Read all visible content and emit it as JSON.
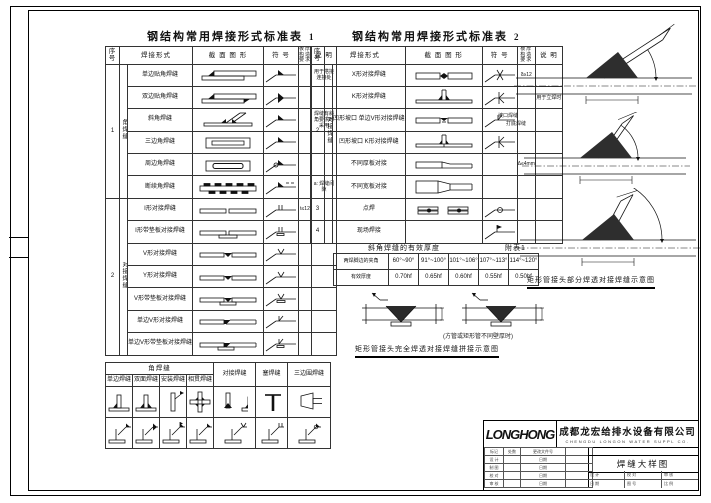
{
  "sheet": {
    "bg": "#ffffff",
    "line_color": "#111111"
  },
  "table1": {
    "title": "钢结构常用焊接形式标准表",
    "title_no": "1",
    "headers": [
      "序 号",
      "焊接形式",
      "截 面 图 形",
      "符 号",
      "板厚构造要求",
      "说 明"
    ],
    "groups": [
      {
        "no": "1",
        "form": "角焊缝",
        "rows": [
          {
            "label": "单边贴角焊缝",
            "fig": "lap1",
            "sym": "fil",
            "thk": "",
            "note": "用于搭接连接处"
          },
          {
            "label": "双边贴角焊缝",
            "fig": "lap2",
            "sym": "fil2",
            "thk": "",
            "note": ""
          },
          {
            "label": "斜角焊缝",
            "fig": "bevel",
            "sym": "fil",
            "thk": "",
            "note": "焊缝有斜角要求时采用"
          },
          {
            "label": "三边角焊缝",
            "fig": "rect3",
            "sym": "fil",
            "thk": "",
            "note": ""
          },
          {
            "label": "周边角焊缝",
            "fig": "perim",
            "sym": "filP",
            "thk": "",
            "note": ""
          },
          {
            "label": "断续角焊缝",
            "fig": "interm",
            "sym": "filD",
            "thk": "",
            "note": "a: 焊缝间隙"
          }
        ]
      },
      {
        "no": "2",
        "form": "对接焊缝",
        "rows": [
          {
            "label": "I形对接焊缝",
            "fig": "buttI",
            "sym": "symI",
            "thk": "t≤12",
            "note": ""
          },
          {
            "label": "I形带垫板对接焊缝",
            "fig": "buttIB",
            "sym": "symIb",
            "thk": "",
            "note": ""
          },
          {
            "label": "V形对接焊缝",
            "fig": "buttV",
            "sym": "symV",
            "thk": "",
            "note": ""
          },
          {
            "label": "Y形对接焊缝",
            "fig": "buttY",
            "sym": "symV",
            "thk": "",
            "note": ""
          },
          {
            "label": "V形带垫板对接焊缝",
            "fig": "buttVB",
            "sym": "symVb",
            "thk": "",
            "note": ""
          },
          {
            "label": "单边V形对接焊缝",
            "fig": "bevS",
            "sym": "symBev",
            "thk": "",
            "note": ""
          },
          {
            "label": "单边V形带垫板对接焊缝",
            "fig": "bevSB",
            "sym": "symBevB",
            "thk": "",
            "note": ""
          }
        ]
      }
    ]
  },
  "table2": {
    "title": "钢结构常用焊接形式标准表",
    "title_no": "2",
    "headers": [
      "序 号",
      "焊接形式",
      "截 面 图 形",
      "符 号",
      "板厚构造要求",
      "说 明"
    ],
    "groups": [
      {
        "no": "2",
        "form": "对接焊缝",
        "rows": [
          {
            "label": "X形对接焊缝",
            "fig": "buttX",
            "sym": "symX",
            "thk": "δ≥12",
            "note": ""
          },
          {
            "label": "K形对接焊缝",
            "fig": "buttK",
            "sym": "symK",
            "thk": "",
            "note": "用于立焊时"
          },
          {
            "label": "凹形坡口 单边V形对接焊缝",
            "fig": "bluntV",
            "sym": "symBev",
            "thk": "",
            "note": ""
          },
          {
            "label": "凹形坡口 K形对接焊缝",
            "fig": "bluntK",
            "sym": "symK",
            "thk": "",
            "note": ""
          },
          {
            "label": "不同厚板对接",
            "fig": "thick",
            "sym": "symNone",
            "thk": "Δ≤4mm",
            "note": ""
          },
          {
            "label": "不同宽板对接",
            "fig": "width",
            "sym": "symNone",
            "thk": "",
            "note": ""
          }
        ]
      },
      {
        "no": "3",
        "form": "",
        "rows": [
          {
            "label": "点焊",
            "fig": "spot",
            "sym": "symSpot",
            "thk": "",
            "note": ""
          }
        ]
      },
      {
        "no": "4",
        "form": "",
        "rows": [
          {
            "label": "现场焊接",
            "fig": "blank",
            "sym": "symField",
            "thk": "",
            "note": ""
          }
        ]
      }
    ]
  },
  "appendix": {
    "title": "斜角焊缝的有效厚度",
    "ref": "附表1",
    "row1_label": "两焊脚边的夹角",
    "row2_label": "有效厚度",
    "angles": [
      "60°~90°",
      "91°~100°",
      "101°~106°",
      "107°~113°",
      "114°~120°"
    ],
    "values": [
      "0.70hf",
      "0.65hf",
      "0.60hf",
      "0.55hf",
      "0.50hf"
    ]
  },
  "splice": {
    "note": "(方管或矩形管不同壁厚时)",
    "caption": "矩形管接头完全焊透对接焊缝拼接示意图"
  },
  "right_diagrams": {
    "label1": "坡口焊缝",
    "label2": "打底焊缝",
    "caption": "矩形管接头部分焊透对接焊缝示意图"
  },
  "corner_table": {
    "group_header": "角焊缝",
    "sub_headers": [
      "单边焊缝",
      "双面焊缝",
      "安装焊缝",
      "相贯焊缝"
    ],
    "other_headers": [
      "对接焊缝",
      "塞焊缝",
      "三边围焊缝"
    ],
    "fig_row": [
      "c1",
      "c2",
      "c3",
      "c4",
      "c5",
      "c6",
      "c7"
    ],
    "sym_row": [
      "s1",
      "s2",
      "s3",
      "s4",
      "s5",
      "s6",
      "s7"
    ]
  },
  "titleblock": {
    "logo": "LONGHONG",
    "company_cn": "成都龙宏给排水设备有限公司",
    "company_en": "CHENGDU LONGON WATER SUPPL CO.",
    "drawing_title": "焊缝大样图",
    "rev_rows": [
      [
        "标记",
        "处数",
        "更改文件号",
        ""
      ],
      [
        "设 计",
        "",
        "日期",
        ""
      ],
      [
        "制 图",
        "",
        "日期",
        ""
      ],
      [
        "校 对",
        "",
        "日期",
        ""
      ],
      [
        "审 核",
        "",
        "日期",
        ""
      ]
    ],
    "sig_cells": [
      [
        "设 计",
        "日 期"
      ],
      [
        "校 对",
        "图 号"
      ],
      [
        "审 核",
        "比 例"
      ]
    ]
  }
}
